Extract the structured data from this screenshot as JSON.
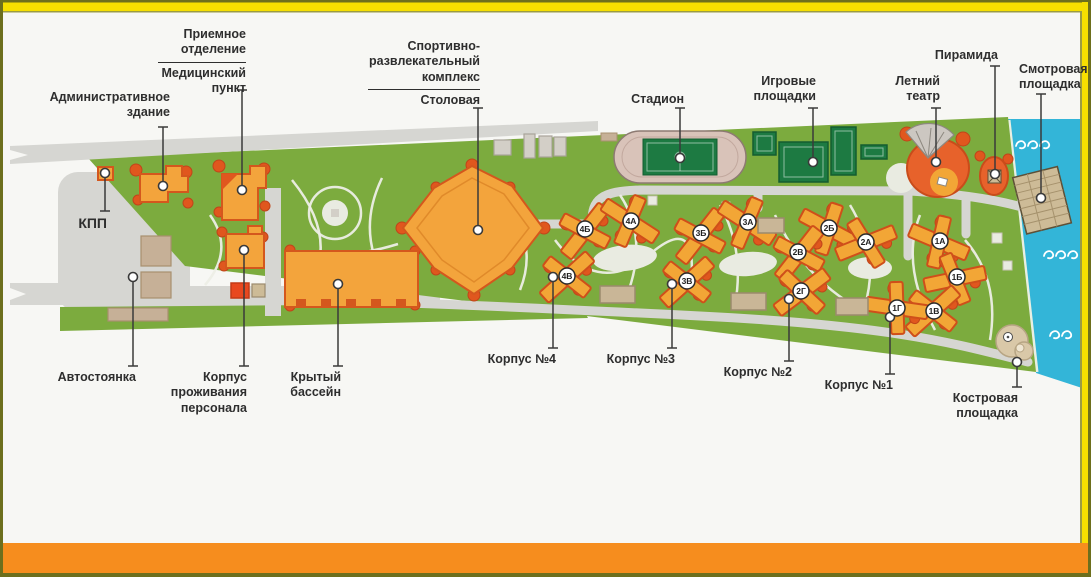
{
  "callouts": {
    "kpp": "КПП",
    "admin": "Административное здание",
    "reception": "Приемное отделение",
    "medical": "Медицинский пункт",
    "sport_complex": "Спортивно-развлекательный комплекс",
    "dining": "Столовая",
    "stadium": "Стадион",
    "playgrounds": "Игровые площадки",
    "summer_theater": "Летний театр",
    "pyramid": "Пирамида",
    "viewing_platform": "Смотровая площадка",
    "parking": "Автостоянка",
    "staff_housing": "Корпус проживания персонала",
    "indoor_pool": "Крытый бассейн",
    "korpus4": "Корпус №4",
    "korpus3": "Корпус №3",
    "korpus2": "Корпус №2",
    "korpus1": "Корпус №1",
    "campfire": "Костровая площадка"
  },
  "badges": [
    "4Б",
    "4А",
    "4В",
    "3Б",
    "3А",
    "3В",
    "2Б",
    "2А",
    "2В",
    "2Г",
    "1А",
    "1Б",
    "1В",
    "1Г"
  ],
  "colors": {
    "site_green": "#7cab3e",
    "water_cyan": "#33b5d8",
    "building_orange": "#f3a43c",
    "building_outline": "#d4571d",
    "accent_red": "#e0571e",
    "court_green": "#1d7a42",
    "road_gray": "#d6d6d2",
    "sand_tan": "#cdbb97",
    "frame_yellow": "#f6df00",
    "frame_orange": "#f68d1e",
    "frame_olive": "#6d6f1d",
    "label_dark": "#2e2e2e"
  }
}
